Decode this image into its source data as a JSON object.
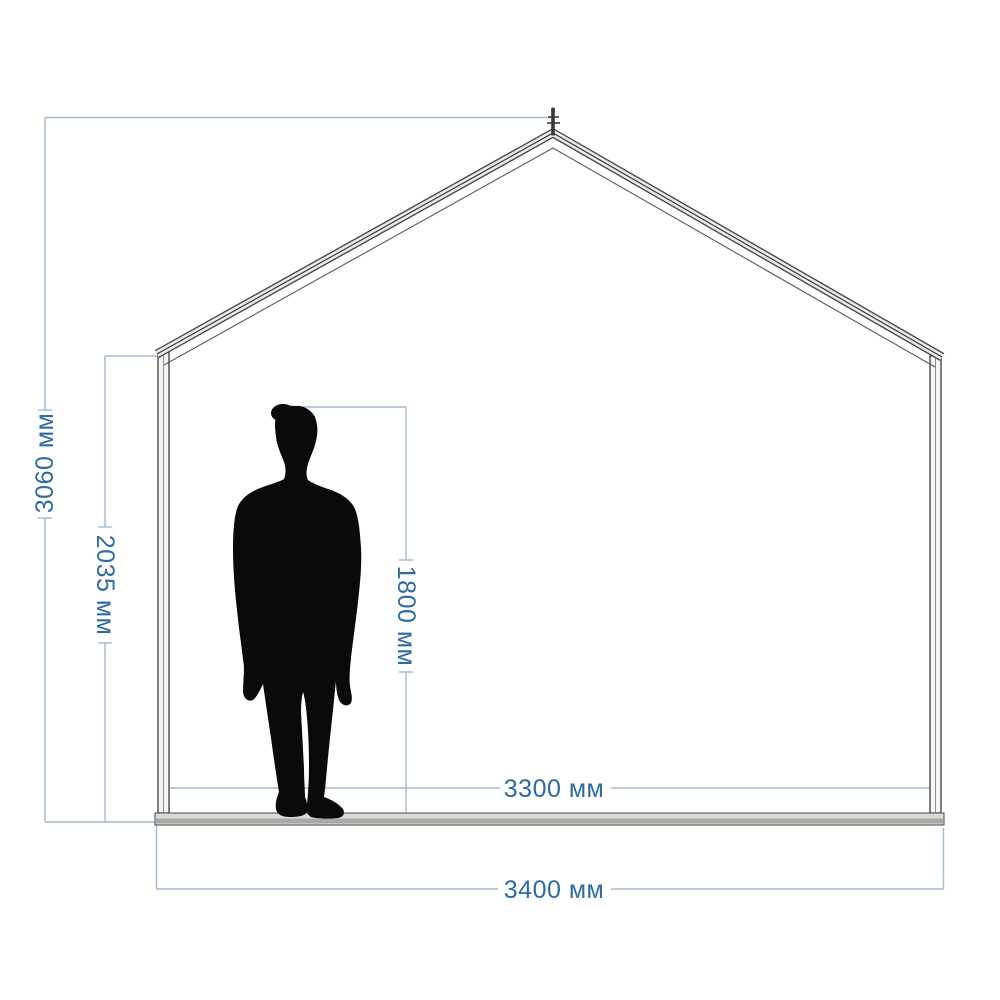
{
  "diagram": {
    "unit": "мм",
    "labels": {
      "total_height": "3060 мм",
      "wall_height": "2035 мм",
      "person_height": "1800 мм",
      "inner_width": "3300 мм",
      "outer_width": "3400 мм"
    },
    "values": {
      "total_height_mm": 3060,
      "wall_height_mm": 2035,
      "person_height_mm": 1800,
      "inner_width_mm": 3300,
      "outer_width_mm": 3400
    },
    "colors": {
      "dimension_text": "#2E6BA5",
      "dimension_line": "#A3B9CD",
      "structure_outline": "#4A4A4A",
      "structure_fill": "#ECECEA",
      "floor_fill": "#A9A9A5",
      "silhouette": "#0A0A0A"
    }
  }
}
